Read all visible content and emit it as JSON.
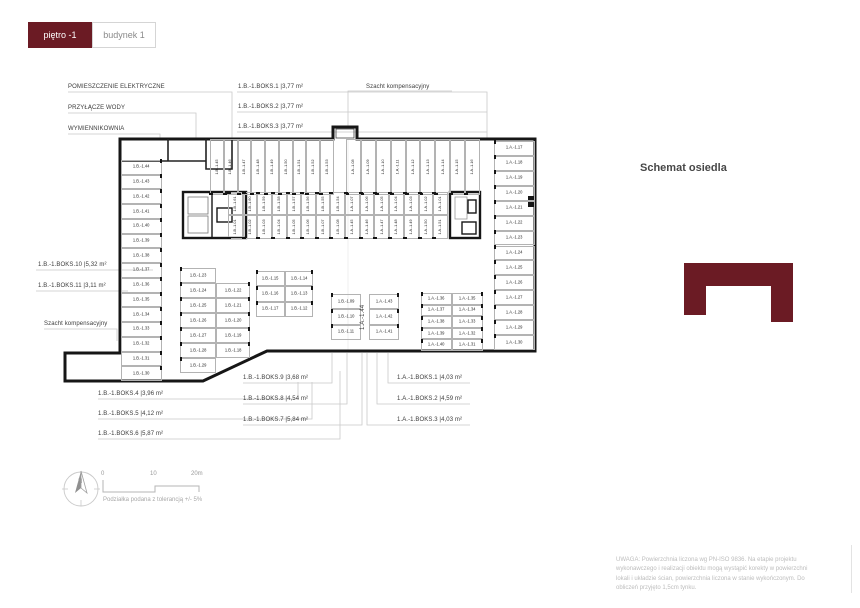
{
  "theme": {
    "accent": "#6b1b24",
    "wall": "#161616",
    "stall_line": "#b3b3b3",
    "leader": "#c9c9c9"
  },
  "tabs": [
    {
      "label": "piętro -1",
      "active": true
    },
    {
      "label": "budynek 1",
      "active": false
    }
  ],
  "schemat": {
    "title": "Schemat osiedla"
  },
  "scale": {
    "ticks": [
      "0",
      "10",
      "20m"
    ],
    "compass": "N",
    "note": "Podziałka podana z tolerancją +/- 5%"
  },
  "footnote": "UWAGA: Powierzchnia liczona wg PN-ISO 9836. Na etapie projektu wykonawczego i realizacji obiektu mogą wystąpić korekty w powierzchni lokali i układzie ścian, powierzchnia liczona w stanie wykończonym. Do obliczeń przyjęto 1,5cm tynku.",
  "plan": {
    "annotations": [
      {
        "text": "POMIESZCZENIE ELEKTRYCZNE",
        "x": 68,
        "y": 84,
        "name": "room-label-electrical"
      },
      {
        "text": "PRZYŁĄCZE WODY",
        "x": 68,
        "y": 105,
        "name": "room-label-water"
      },
      {
        "text": "WYMIENNIKOWNIA",
        "x": 68,
        "y": 126,
        "name": "room-label-exchanger"
      },
      {
        "text": "1.B.-1.BOKS.1 |3,77 m²",
        "x": 238,
        "y": 84,
        "name": "boks-label"
      },
      {
        "text": "1.B.-1.BOKS.2 |3,77 m²",
        "x": 238,
        "y": 104,
        "name": "boks-label"
      },
      {
        "text": "1.B.-1.BOKS.3 |3,77 m²",
        "x": 238,
        "y": 124,
        "name": "boks-label"
      },
      {
        "text": "Szacht kompensacyjny",
        "x": 366,
        "y": 84,
        "name": "shaft-label-top"
      },
      {
        "text": "1.B.-1.BOKS.10 |5,32 m²",
        "x": 38,
        "y": 262,
        "name": "boks-label"
      },
      {
        "text": "1.B.-1.BOKS.11 |3,11 m²",
        "x": 38,
        "y": 283,
        "name": "boks-label"
      },
      {
        "text": "Szacht kompensacyjny",
        "x": 44,
        "y": 321,
        "name": "shaft-label-left"
      },
      {
        "text": "1.B.-1.BOKS.4 |3,96 m²",
        "x": 98,
        "y": 391,
        "name": "boks-label"
      },
      {
        "text": "1.B.-1.BOKS.5 |4,12 m²",
        "x": 98,
        "y": 411,
        "name": "boks-label"
      },
      {
        "text": "1.B.-1.BOKS.6 |5,87 m²",
        "x": 98,
        "y": 431,
        "name": "boks-label"
      },
      {
        "text": "1.B.-1.BOKS.9 |3,68 m²",
        "x": 243,
        "y": 375,
        "name": "boks-label"
      },
      {
        "text": "1.B.-1.BOKS.8 |4,54 m²",
        "x": 243,
        "y": 396,
        "name": "boks-label"
      },
      {
        "text": "1.B.-1.BOKS.7 |5,84 m²",
        "x": 243,
        "y": 417,
        "name": "boks-label"
      },
      {
        "text": "1.A.-1.BOKS.1 |4,03 m²",
        "x": 397,
        "y": 375,
        "name": "boks-label"
      },
      {
        "text": "1.A.-1.BOKS.2 |4,59 m²",
        "x": 397,
        "y": 396,
        "name": "boks-label"
      },
      {
        "text": "1.A.-1.BOKS.3 |4,03 m²",
        "x": 397,
        "y": 417,
        "name": "boks-label"
      },
      {
        "text": "1.A.-1.44",
        "x": 360,
        "y": 330,
        "rotate": true,
        "name": "stall-label-rotated"
      }
    ],
    "stall_groups": [
      {
        "name": "left-column",
        "orient": "h",
        "tick": "right",
        "x": 121,
        "y": 160,
        "w": 41,
        "h": 221,
        "labels": [
          "1.B.-1.44",
          "1.B.-1.43",
          "1.B.-1.42",
          "1.B.-1.41",
          "1.B.-1.40",
          "1.B.-1.39",
          "1.B.-1.38",
          "1.B.-1.37",
          "1.B.-1.36",
          "1.B.-1.35",
          "1.B.-1.34",
          "1.B.-1.33",
          "1.B.-1.32",
          "1.B.-1.31",
          "1.B.-1.30"
        ]
      },
      {
        "name": "top-row-b",
        "orient": "v",
        "tick": "bottom",
        "x": 210,
        "y": 139,
        "w": 124,
        "h": 56,
        "labels": [
          "1.B.-1.45",
          "1.B.-1.46",
          "1.B.-1.47",
          "1.B.-1.48",
          "1.B.-1.49",
          "1.B.-1.50",
          "1.B.-1.51",
          "1.B.-1.52",
          "1.B.-1.53"
        ]
      },
      {
        "name": "top-row-a",
        "orient": "v",
        "tick": "bottom",
        "x": 346,
        "y": 139,
        "w": 134,
        "h": 56,
        "labels": [
          "1.A.-1.08",
          "1.A.-1.09",
          "1.A.-1.10",
          "1.A.-1.11",
          "1.A.-1.12",
          "1.A.-1.13",
          "1.A.-1.14",
          "1.A.-1.15",
          "1.A.-1.16"
        ]
      },
      {
        "name": "right-column",
        "orient": "h",
        "tick": "left",
        "x": 494,
        "y": 141,
        "w": 41,
        "h": 209,
        "labels": [
          "1.A.-1.17",
          "1.A.-1.18",
          "1.A.-1.19",
          "1.A.-1.20",
          "1.A.-1.21",
          "1.A.-1.22",
          "1.A.-1.23",
          "1.A.-1.24",
          "1.A.-1.25",
          "1.A.-1.26",
          "1.A.-1.27",
          "1.A.-1.28",
          "1.A.-1.29",
          "1.A.-1.30"
        ]
      },
      {
        "name": "mid-top-b",
        "orient": "v",
        "tick": "top",
        "x": 228,
        "y": 192,
        "w": 117,
        "h": 23,
        "labels": [
          "1.B.-1.61",
          "1.B.-1.60",
          "1.B.-1.59",
          "1.B.-1.58",
          "1.B.-1.57",
          "1.B.-1.56",
          "1.B.-1.55",
          "1.B.-1.54"
        ]
      },
      {
        "name": "mid-top-a",
        "orient": "v",
        "tick": "top",
        "x": 345,
        "y": 192,
        "w": 103,
        "h": 23,
        "labels": [
          "1.A.-1.07",
          "1.A.-1.06",
          "1.A.-1.05",
          "1.A.-1.04",
          "1.A.-1.03",
          "1.A.-1.02",
          "1.A.-1.01"
        ]
      },
      {
        "name": "mid-bottom-b",
        "orient": "v",
        "tick": "bottom",
        "x": 228,
        "y": 215,
        "w": 117,
        "h": 24,
        "labels": [
          "1.B.-1.01",
          "1.B.-1.02",
          "1.B.-1.03",
          "1.B.-1.04",
          "1.B.-1.05",
          "1.B.-1.06",
          "1.B.-1.07",
          "1.B.-1.08"
        ]
      },
      {
        "name": "mid-bottom-a",
        "orient": "v",
        "tick": "bottom",
        "x": 345,
        "y": 215,
        "w": 103,
        "h": 24,
        "labels": [
          "1.A.-1.45",
          "1.A.-1.46",
          "1.A.-1.47",
          "1.A.-1.48",
          "1.A.-1.49",
          "1.A.-1.50",
          "1.A.-1.51"
        ]
      },
      {
        "name": "block-a-left",
        "orient": "h",
        "tick": "left",
        "x": 180,
        "y": 268,
        "w": 36,
        "h": 105,
        "labels": [
          "1.B.-1.23",
          "1.B.-1.24",
          "1.B.-1.25",
          "1.B.-1.26",
          "1.B.-1.27",
          "1.B.-1.28",
          "1.B.-1.29"
        ]
      },
      {
        "name": "block-a-right",
        "orient": "h",
        "tick": "right",
        "x": 216,
        "y": 283,
        "w": 34,
        "h": 75,
        "labels": [
          "1.B.-1.22",
          "1.B.-1.21",
          "1.B.-1.20",
          "1.B.-1.19",
          "1.B.-1.18"
        ]
      },
      {
        "name": "block-b-left",
        "orient": "h",
        "tick": "left",
        "x": 256,
        "y": 271,
        "w": 29,
        "h": 46,
        "labels": [
          "1.B.-1.15",
          "1.B.-1.16",
          "1.B.-1.17"
        ]
      },
      {
        "name": "block-b-right",
        "orient": "h",
        "tick": "right",
        "x": 285,
        "y": 271,
        "w": 28,
        "h": 46,
        "labels": [
          "1.B.-1.14",
          "1.B.-1.13",
          "1.B.-1.12"
        ]
      },
      {
        "name": "block-c-left",
        "orient": "h",
        "tick": "left",
        "x": 331,
        "y": 294,
        "w": 30,
        "h": 46,
        "labels": [
          "1.B.-1.09",
          "1.B.-1.10",
          "1.B.-1.11"
        ]
      },
      {
        "name": "block-c-right",
        "orient": "h",
        "tick": "right",
        "x": 369,
        "y": 294,
        "w": 30,
        "h": 46,
        "labels": [
          "1.A.-1.43",
          "1.A.-1.42",
          "1.A.-1.41"
        ]
      },
      {
        "name": "block-d-left",
        "orient": "h",
        "tick": "left",
        "x": 421,
        "y": 293,
        "w": 31,
        "h": 58,
        "labels": [
          "1.A.-1.36",
          "1.A.-1.37",
          "1.A.-1.38",
          "1.A.-1.39",
          "1.A.-1.40"
        ]
      },
      {
        "name": "block-d-right",
        "orient": "h",
        "tick": "right",
        "x": 452,
        "y": 293,
        "w": 31,
        "h": 58,
        "labels": [
          "1.A.-1.35",
          "1.A.-1.34",
          "1.A.-1.33",
          "1.A.-1.32",
          "1.A.-1.31"
        ]
      }
    ]
  }
}
